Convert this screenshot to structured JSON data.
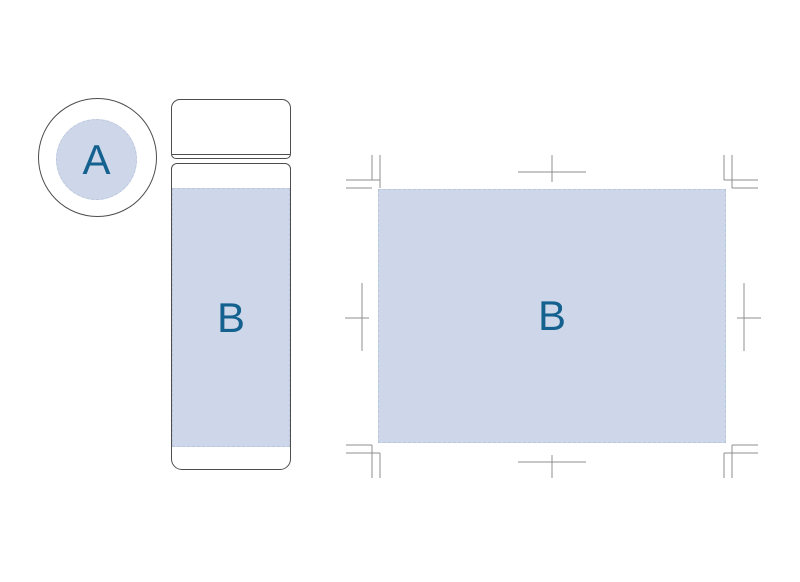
{
  "colors": {
    "print_area_fill": "#cdd7e9",
    "print_area_dash": "#b9c6db",
    "product_outline": "#4d4d4d",
    "crop_mark": "#8f8f8f",
    "label_text": "#14618f",
    "background": "#ffffff"
  },
  "lid_top_view": {
    "print_area_label": "A"
  },
  "bottle_side_view": {
    "print_area_label": "B"
  },
  "unwrapped_print_area": {
    "print_area_label": "B"
  }
}
